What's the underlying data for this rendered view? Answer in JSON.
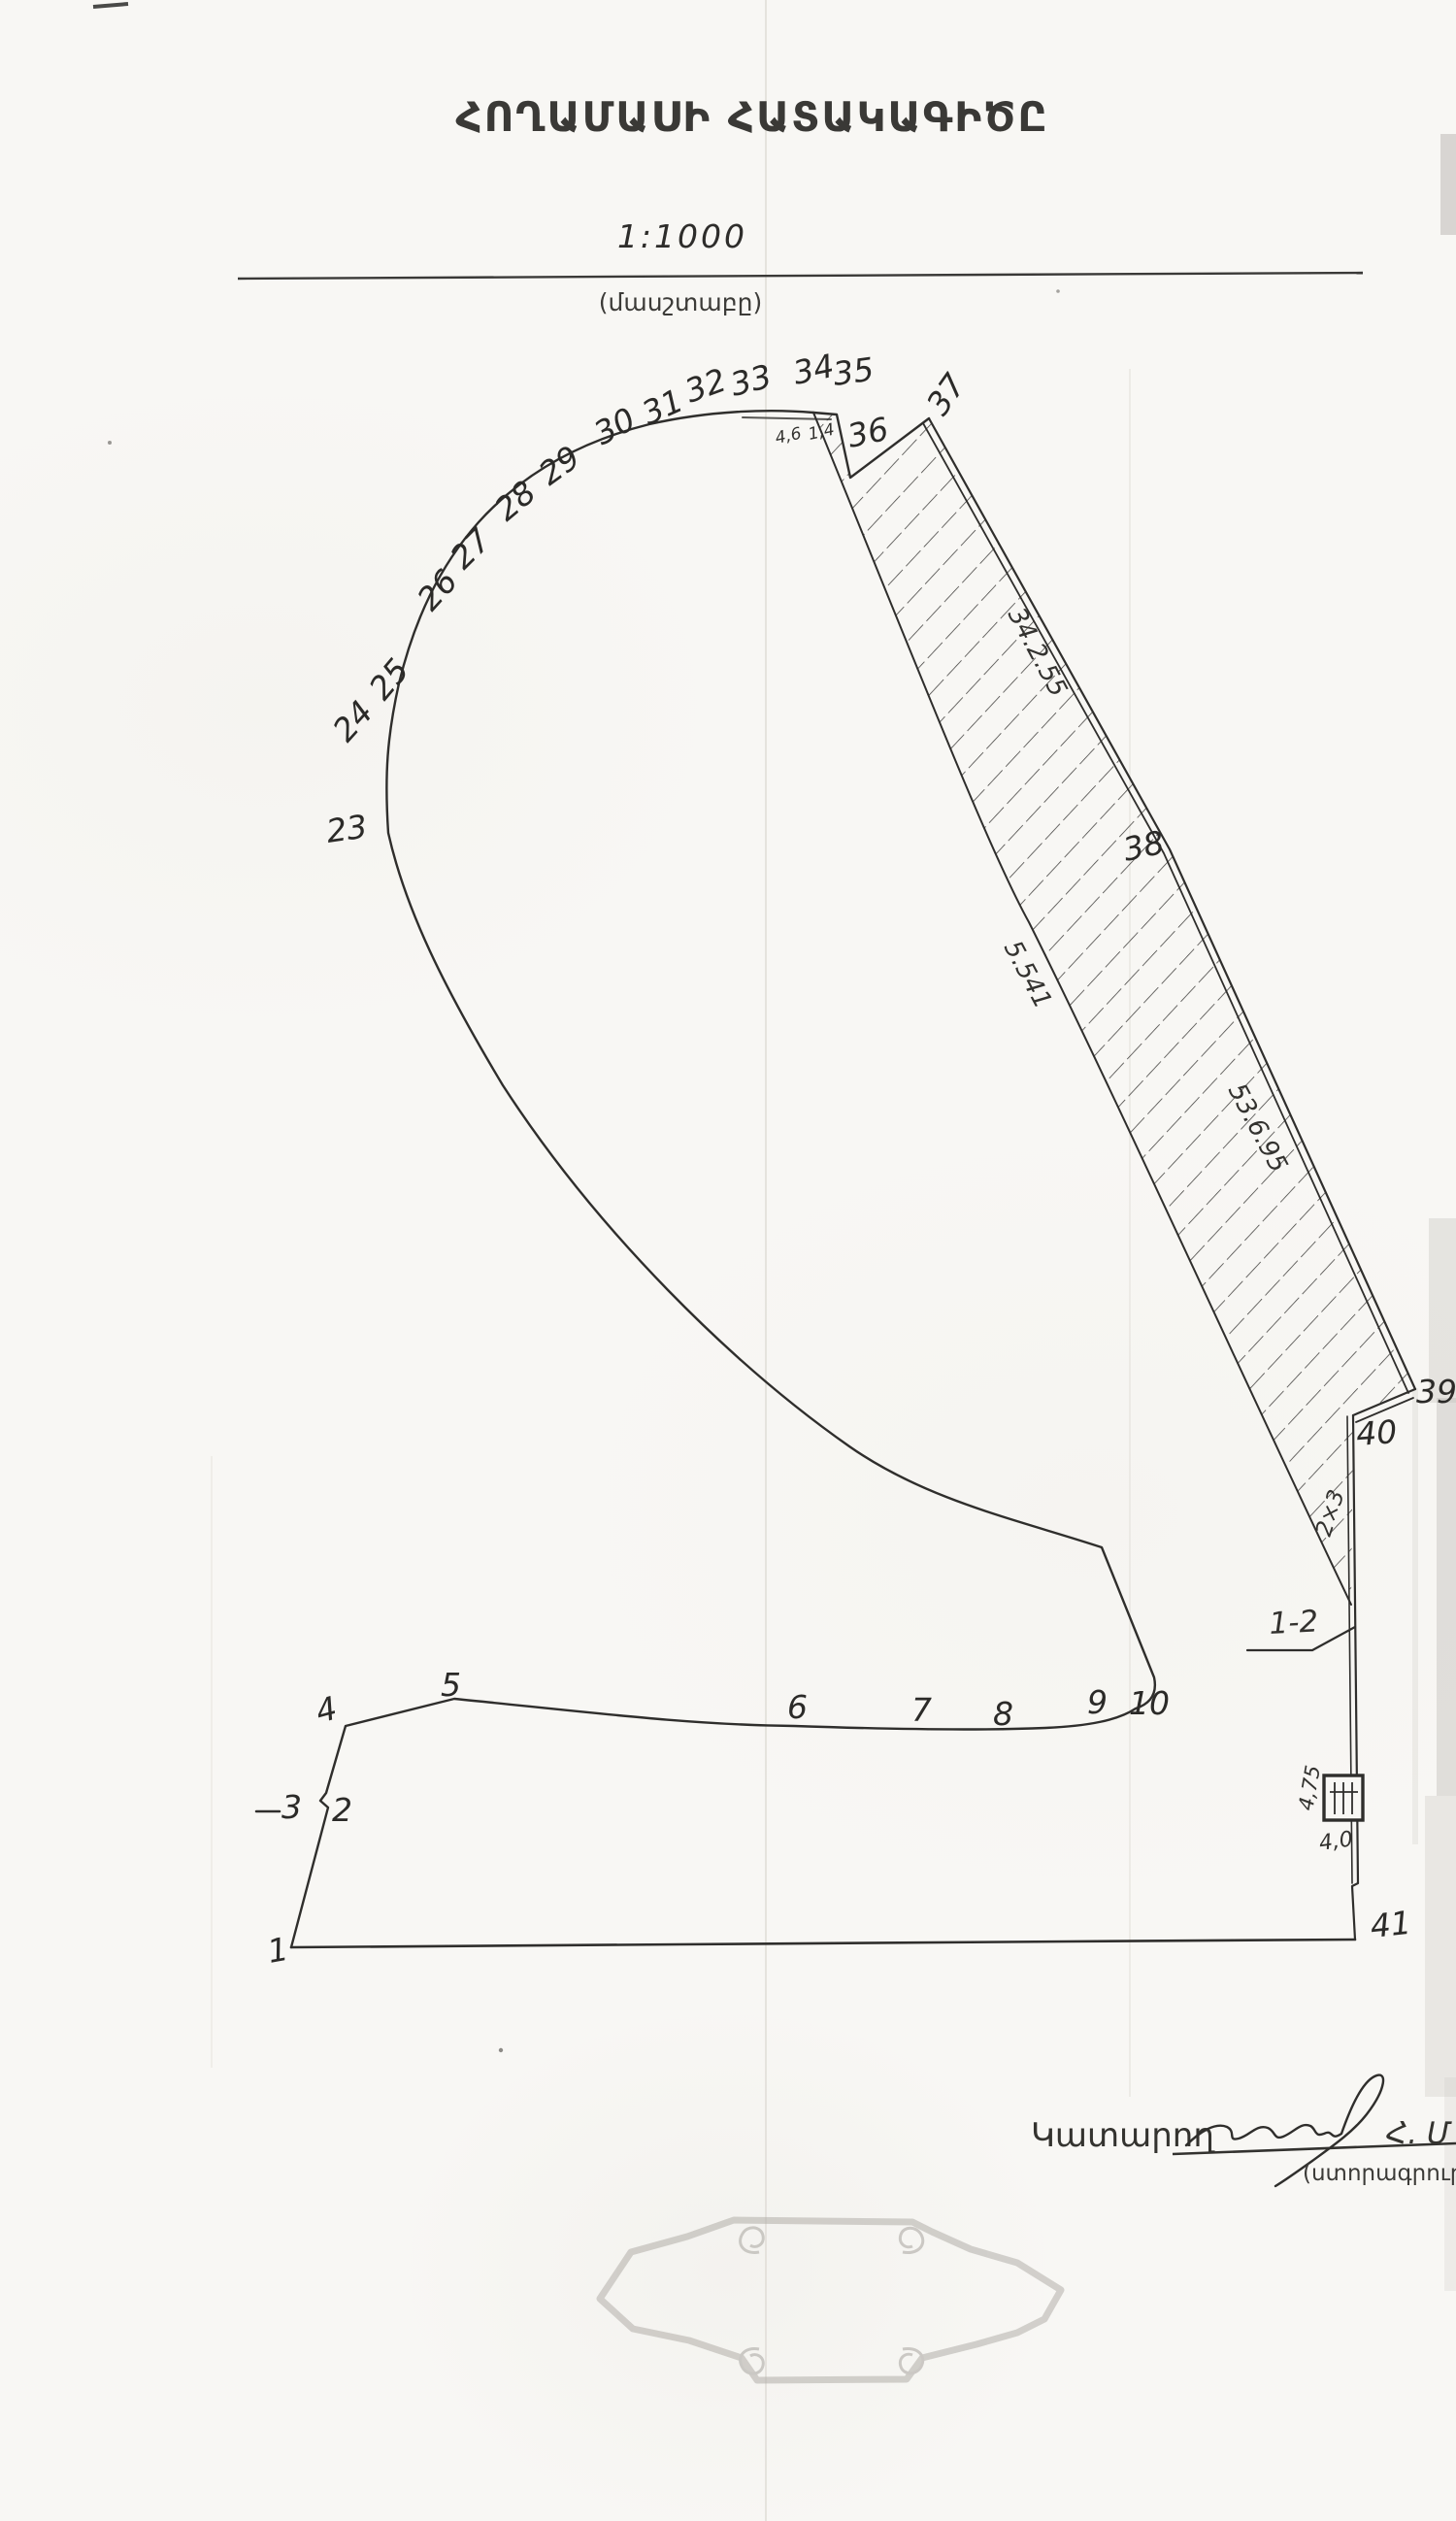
{
  "page": {
    "title": "ՀՈՂԱՄԱՍԻ ՀԱՏԱԿԱԳԻԾԸ",
    "scale": {
      "value": "1:1000",
      "caption": "(մասշտաբը)"
    }
  },
  "plan": {
    "points": [
      {
        "label": "1"
      },
      {
        "label": "2"
      },
      {
        "label": "3"
      },
      {
        "label": "4"
      },
      {
        "label": "5"
      },
      {
        "label": "6"
      },
      {
        "label": "7"
      },
      {
        "label": "8"
      },
      {
        "label": "9"
      },
      {
        "label": "10"
      },
      {
        "label": "23"
      },
      {
        "label": "24"
      },
      {
        "label": "25"
      },
      {
        "label": "26"
      },
      {
        "label": "27"
      },
      {
        "label": "28"
      },
      {
        "label": "29"
      },
      {
        "label": "30"
      },
      {
        "label": "31"
      },
      {
        "label": "32"
      },
      {
        "label": "33"
      },
      {
        "label": "34"
      },
      {
        "label": "35"
      },
      {
        "label": "36"
      },
      {
        "label": "37"
      },
      {
        "label": "38"
      },
      {
        "label": "39"
      },
      {
        "label": "40"
      },
      {
        "label": "41"
      }
    ],
    "measurements": [
      {
        "id": "seg-33-34",
        "text": "4,6"
      },
      {
        "id": "seg-34-35",
        "text": "1,4"
      },
      {
        "id": "strip-upper",
        "text": "34.2.55"
      },
      {
        "id": "strip-middle",
        "text": "5.541"
      },
      {
        "id": "strip-lower",
        "text": "53.6.95"
      },
      {
        "id": "sliver",
        "text": "2×3"
      },
      {
        "id": "box-side",
        "text": "4,75"
      },
      {
        "id": "box-bottom",
        "text": "4,0"
      },
      {
        "id": "parcel-ref",
        "text": "1-2"
      }
    ],
    "ink_color": "#2f2e2c",
    "hatch_color": "#3d3c3a",
    "stamp_color": "#b2afa9"
  },
  "footer": {
    "executor_label": "Կատարող",
    "executor_name": "Հ. Մ",
    "signature_caption": "(ստորագրությունը)"
  }
}
